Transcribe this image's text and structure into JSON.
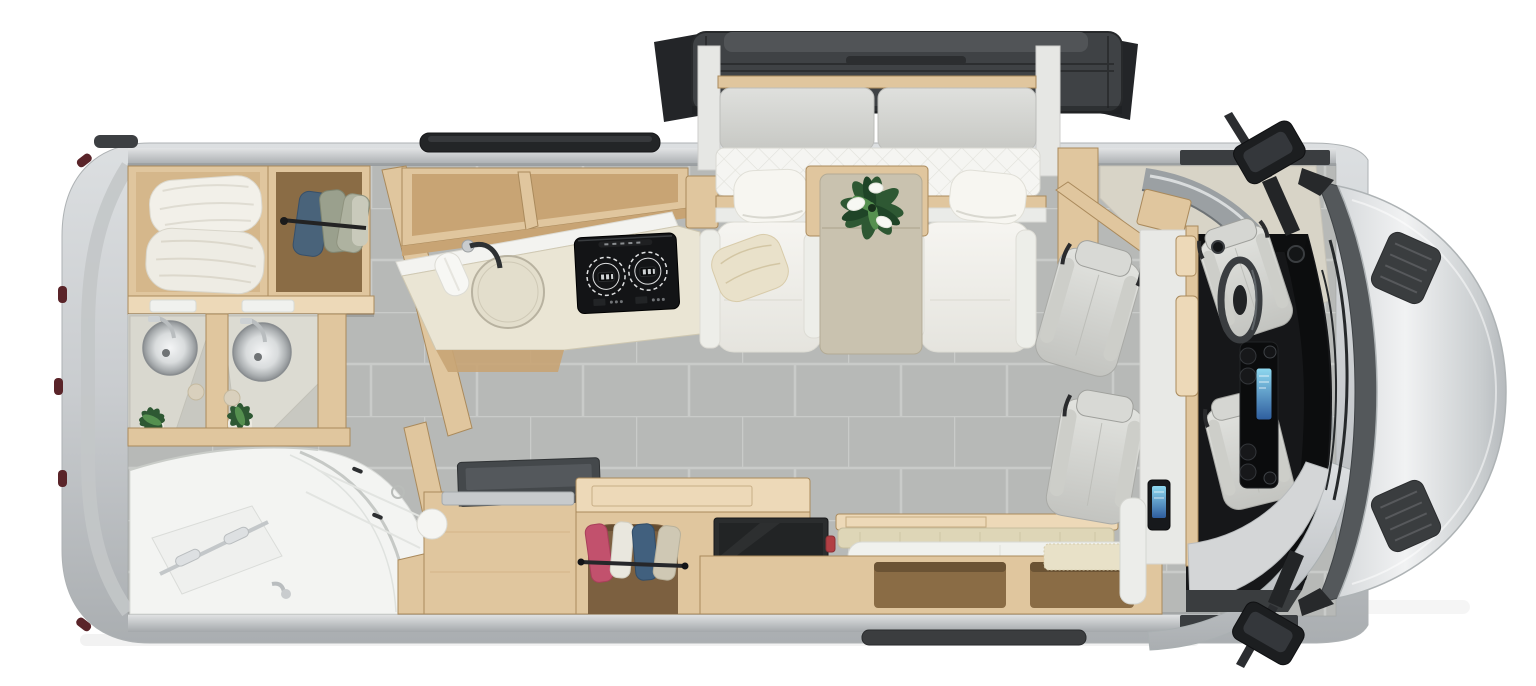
{
  "meta": {
    "title": "Top-down cutaway rendering of a Class B+ motorhome interior floor plan",
    "render_type": "3d-overhead-floorplan",
    "canvas": {
      "width": 1536,
      "height": 686
    },
    "vehicle_orientation": "cab-and-hood-on-right, rear-bath-on-left, bed-slide-out-extended-at-top"
  },
  "palette": {
    "background": "#ffffff",
    "body_silver_light": "#e9ebec",
    "body_silver": "#c9cccf",
    "body_silver_dark": "#aaaeb1",
    "wall_band_light": "#e2e4e5",
    "wall_band_dark": "#a4a8ab",
    "rear_marker_red": "#5a2429",
    "floor_tile": "#b7b9b7",
    "tile_grout": "#c9cbc9",
    "wood": "#e0c69e",
    "wood_light": "#edd9b8",
    "wood_dark": "#c8a474",
    "wood_edge": "#aa8a5c",
    "wood_interior": "#8a6c45",
    "stone_counter": "#eae5d4",
    "stone_edge": "#cfc8b2",
    "soft_white": "#f4f4f1",
    "soft_white_edge": "#dcdbd4",
    "cushion_gray": "#d6d7d4",
    "slide_roof": "#3f4245",
    "slide_roof_dark": "#27292b",
    "slide_roof_lip": "#515457",
    "mattress_white": "#f5f5f2",
    "quilt_line": "#e1e1db",
    "chair_white": "#f1f0eb",
    "pillow_cream": "#e9e1ca",
    "table_taupe": "#c9c2af",
    "table_taupe_edge": "#b3ab95",
    "plant_green": "#2e5833",
    "plant_green_light": "#55904f",
    "flower_white": "#f7f8f3",
    "cooktop_black": "#131416",
    "burner_ring": "#dfe0e1",
    "cab_floor_black": "#161719",
    "dashboard_black": "#0c0d0e",
    "cab_seat_light": "#e2e3df",
    "cab_seat_shade": "#c3c4c0",
    "screen_blue_light": "#8fd9f0",
    "screen_blue_deep": "#2e5d9e",
    "partition_white": "#e8e9e6",
    "overcab_beige": "#d8d4c7",
    "windshield_gray": "#54585b",
    "mirror_black": "#1c1e20",
    "mirror_face": "#34373b",
    "bench_beige": "#ded6b7",
    "tv_black": "#2b2d2e",
    "step_dark": "#3b3d3f",
    "chrome": "#cdd1d3",
    "glass_line": "#c6c9c6",
    "sink_steel": "#aeb2b4",
    "garment_blue": "#49637a",
    "garment_sage": "#9aa08d",
    "garment_pink": "#c2516d",
    "garment_navy": "#41607e",
    "garment_beige": "#cfc8b4",
    "red_accent": "#b23f44"
  },
  "inventory": {
    "rear_bath": [
      "linen-cabinet-with-two-pillows",
      "hanging-clothes-closet",
      "dual-round-stainless-vanity-sinks",
      "chrome-faucets",
      "potted-plants",
      "curved-glass-shower-enclosure",
      "shower-towel-bar",
      "wood-threshold"
    ],
    "kitchen": [
      "angled-wood-partition-wall",
      "overhead-open-shelving",
      "stone-countertop",
      "round-inset-sink",
      "black-faucet",
      "paper-towel-roll",
      "two-burner-induction-cooktop",
      "lower-wood-cabinets",
      "dark-griddle-slab",
      "hanging-shoe-wardrobe-cubby"
    ],
    "lounge": [
      "slide-out-roof-panel",
      "gray-sofa-back-cushions",
      "white-quilted-murphy-bed-mattress",
      "left-white-lounge-chair",
      "right-white-lounge-chair",
      "cream-throw-pillow",
      "taupe-pedestal-table",
      "peace-lily-plant",
      "wall-mounted-tv",
      "bench-seat-with-beige-cushion",
      "white-bolster-cushion",
      "open-storage-cubbies",
      "entry-carpet-mat"
    ],
    "cab": [
      "white-partition-wall-with-wood-trim",
      "blue-control-panel",
      "two-swivel-captain-chairs",
      "driver-seat",
      "passenger-seat",
      "steering-wheel",
      "center-console-with-blue-screen",
      "cup-holders",
      "dashboard",
      "windshield-with-wipers",
      "silver-hood-with-vent-grilles",
      "upper-side-mirror",
      "lower-side-mirror",
      "entry-step-fender",
      "running-board",
      "roof-vent",
      "rear-marker-lights"
    ]
  }
}
